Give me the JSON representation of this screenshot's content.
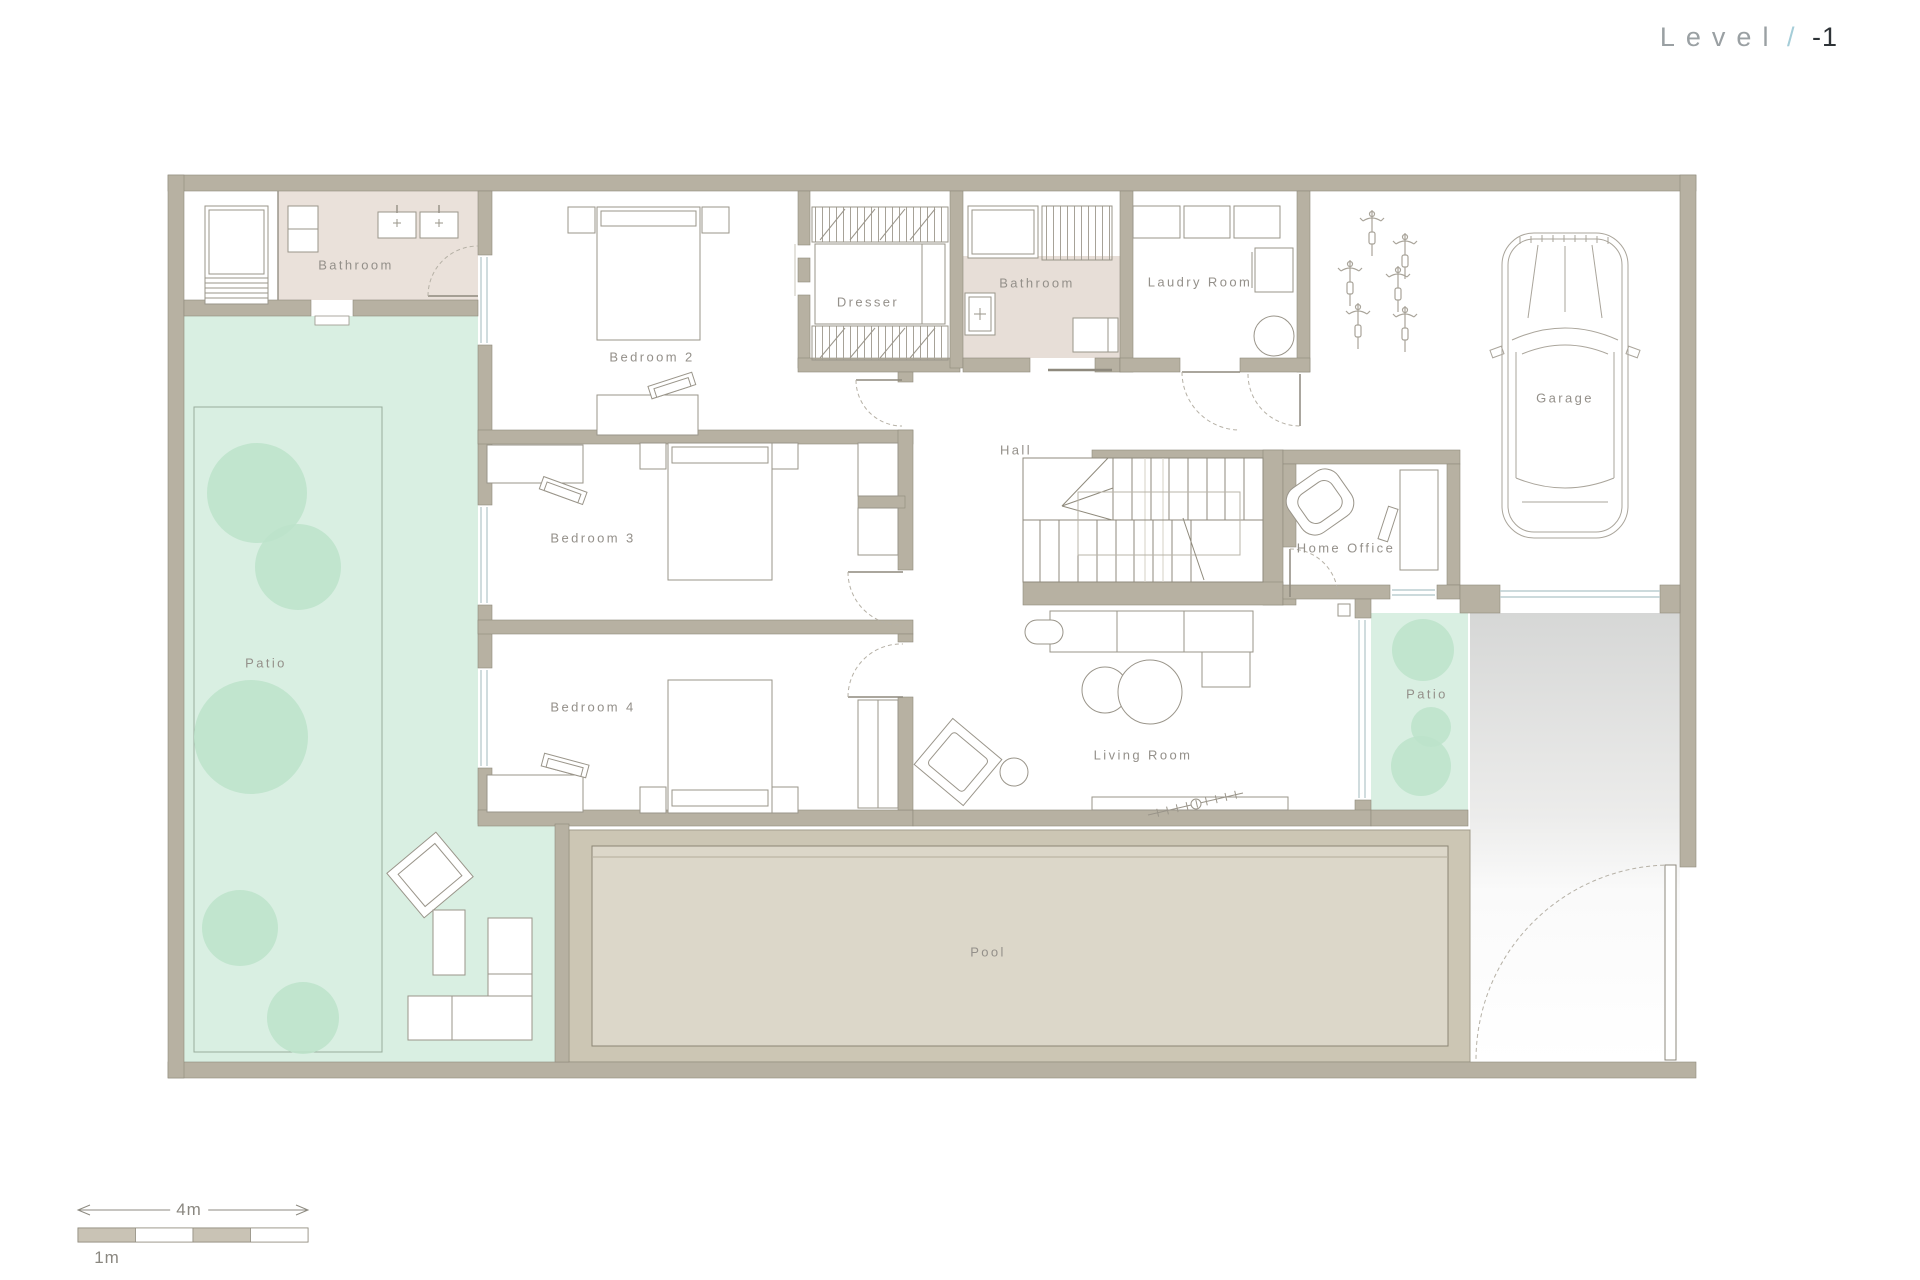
{
  "title": {
    "level_label": "Level",
    "separator": "/",
    "level_value": "-1"
  },
  "rooms": {
    "bathroom_top_left": {
      "label": "Bathroom"
    },
    "bedroom_2": {
      "label": "Bedroom 2"
    },
    "dresser": {
      "label": "Dresser"
    },
    "bathroom_middle": {
      "label": "Bathroom"
    },
    "laundry_room": {
      "label": "Laudry Room"
    },
    "garage": {
      "label": "Garage"
    },
    "hall": {
      "label": "Hall"
    },
    "bedroom_3": {
      "label": "Bedroom 3"
    },
    "home_office": {
      "label": "Home Office"
    },
    "bedroom_4": {
      "label": "Bedroom 4"
    },
    "patio_left": {
      "label": "Patio"
    },
    "living_room": {
      "label": "Living Room"
    },
    "patio_right": {
      "label": "Patio"
    },
    "pool": {
      "label": "Pool"
    }
  },
  "scale_bar": {
    "total_length_label": "4m",
    "segment_label": "1m"
  },
  "colors": {
    "wall": "#b7b1a2",
    "wall_outline": "#8f8a7c",
    "bathroom_floor": "#eae1da",
    "patio_green": "#d9efe2",
    "tree_green": "#bce3ca",
    "pool_deck": "#ccc6b4",
    "pool_water": "#dcd7c9",
    "driveway_gray": "#d6d7d6",
    "line_work": "#9a958a",
    "label_text": "#94908a",
    "title_gray": "#9aa0a3",
    "title_slash_blue": "#a5cdd8",
    "title_value_dark": "#2e3337"
  }
}
